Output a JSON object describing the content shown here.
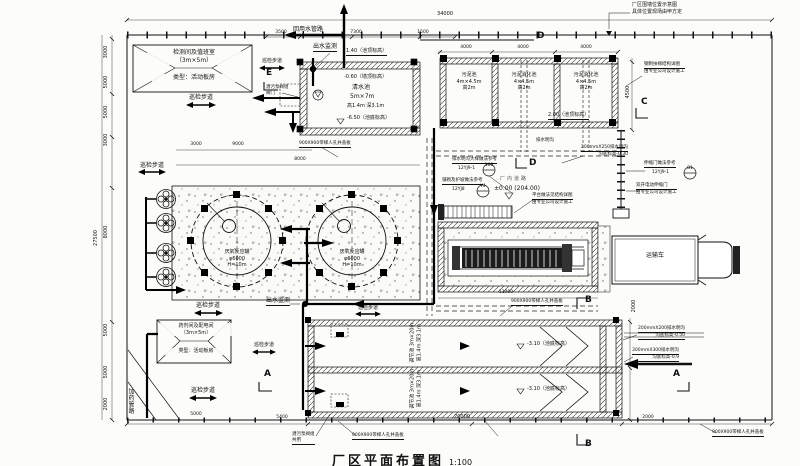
{
  "title": {
    "main": "厂区平面布置图",
    "scale": "1:100"
  },
  "t": {
    "walkway": "巡检步道",
    "manhole": "900X900带梯人孔井盖板",
    "outflow": "出水监测",
    "reuse": "回用水管路",
    "truck": "运输车",
    "road": "厂内道路",
    "road_elev": "±0.00 (204.00)",
    "ditch_small": "排水明沟",
    "dosing": "加药管路",
    "valve1": "潜污泵阀组",
    "valve_top2": "阀门",
    "valve_bot2": "共用"
  },
  "b1": {
    "l1": "检测间及值班室",
    "l2": "（3m×5m）",
    "l3": "类型：活动板房"
  },
  "b2": {
    "l1": "药剂间及配电间",
    "l2": "（3m×5m）",
    "l3": "类型：活动板房"
  },
  "cw": {
    "top": "1.40（池顶标高）",
    "wall": "-0.60（墙顶标高）",
    "name": "清水池",
    "size": "5m×7m",
    "dims": "高1.4m 深3.1m",
    "bot": "-6.50（池底标高）"
  },
  "sl": {
    "c1_1": "污泥池",
    "c1_2": "4m×4.5m",
    "c1_3": "高2m",
    "c2_1": "污泥消化池",
    "c2_2": "4×4.5m",
    "c2_3": "高2m",
    "elev": "2.00（池顶标高）"
  },
  "rx": {
    "name": "厌氧反应罐",
    "dia": "φ6000",
    "h": "H=10m"
  },
  "reg": {
    "l1": "调节池",
    "l2": "3m×20m",
    "l3": "高1.4m 深3.1m",
    "elev": "-3.10（池底标高）"
  },
  "notes": {
    "fence1": "厂区围墙位置示意图",
    "fence2": "具体位置现场由甲方定",
    "ladder": "钢制扶梯结构详图",
    "pro": "由专业公司设计施工",
    "platform": "平台做法见结构详图",
    "ditch_ref": "排水明沟大样做法参考",
    "ref1": "12YJ9-1",
    "num1": "100",
    "pave_ref": "铺砌及护坡做法参考",
    "ref2": "12YJ8",
    "num2": "Y4",
    "gate_ref": "伸缩门做法参考",
    "ref3": "12YJ9-1",
    "num3": "81",
    "gate": "双开电动伸缩门",
    "d250a": "200mmX250排水明沟",
    "d250b": "沟底标高-0.30",
    "d200a": "200mmX200排水明沟",
    "d200b": "沟底标高-0.50",
    "d300a": "300mmX300排水明沟",
    "d300b": "沟底标高-0.9"
  },
  "dims": {
    "a34000": "34000",
    "a3500": "3500",
    "a7300": "7300",
    "a1500": "1500",
    "a4000": "4000",
    "l3000": "3000",
    "l5000": "5000",
    "l27500": "27500",
    "l8000": "8000",
    "l2000": "2000",
    "b5400": "5400",
    "b20000": "20000",
    "b5000": "5000",
    "b2000": "2000",
    "b9000": "9000",
    "d11000": "11000",
    "r4500": "4500"
  },
  "sec": {
    "a": "A",
    "b": "B",
    "c": "C",
    "d": "D",
    "e": "E"
  }
}
